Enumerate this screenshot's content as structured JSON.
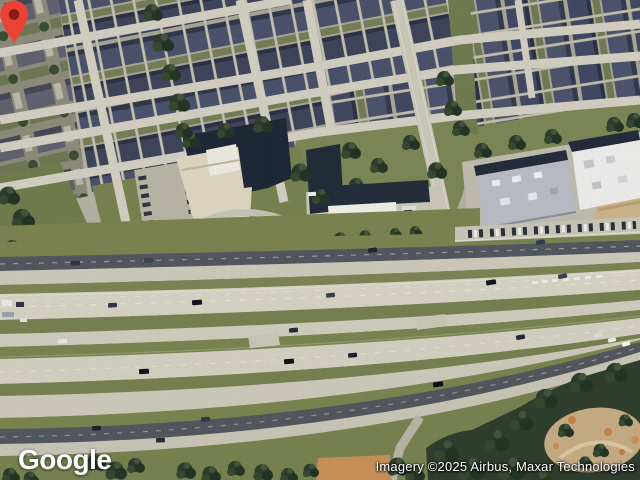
{
  "branding": {
    "logo_text": "Google"
  },
  "attribution": {
    "text": "Imagery ©2025 Airbus, Maxar Technologies"
  },
  "marker": {
    "fill": "#EA4335",
    "dot": "#8F1A12"
  }
}
